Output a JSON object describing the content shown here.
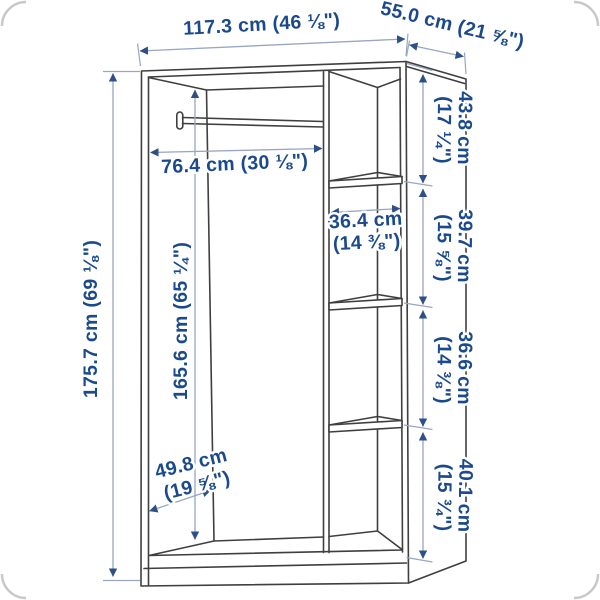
{
  "colors": {
    "dim_text": "#1a4a8c",
    "dim_line": "#98a6c4",
    "arrow": "#2d5186",
    "outline": "#3f3f3f",
    "corner_frame": "#c9c9c9"
  },
  "labels": {
    "overall_width": "117.3 cm (46 ⅛\")",
    "overall_depth": "55.0 cm (21 ⅝\")",
    "overall_height": "175.7 cm (69 ⅛\")",
    "rail_clearance_width": "76.4 cm (30 ⅛\")",
    "interior_height": "165.6 cm (65 ¼\")",
    "shelf_width": {
      "cm": "36.4 cm",
      "inch": "(14 ⅜\")"
    },
    "interior_depth": {
      "cm": "49.8 cm",
      "inch": "(19 ⅝\")"
    },
    "right_compartments": [
      {
        "cm": "43.8 cm",
        "inch": "(17 ¼\")"
      },
      {
        "cm": "39.7 cm",
        "inch": "(15 ⅝\")"
      },
      {
        "cm": "36.6 cm",
        "inch": "(14 ⅜\")"
      },
      {
        "cm": "40.1 cm",
        "inch": "(15 ¾\")"
      }
    ]
  }
}
